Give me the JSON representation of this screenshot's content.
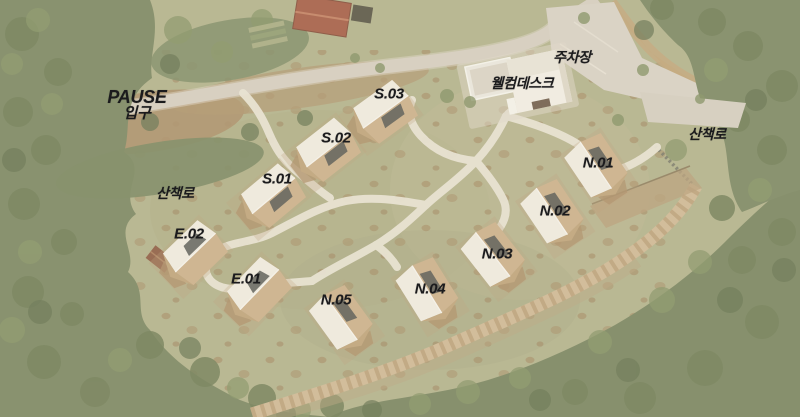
{
  "site_map": {
    "entrance": {
      "name": "PAUSE",
      "label": "입구"
    },
    "facilities": {
      "parking": "주차장",
      "welcome_desk": "웰컴데스크"
    },
    "trails": {
      "west": "산책로",
      "east": "산책로"
    },
    "units": {
      "s01": "S.01",
      "s02": "S.02",
      "s03": "S.03",
      "n01": "N.01",
      "n02": "N.02",
      "n03": "N.03",
      "n04": "N.04",
      "n05": "N.05",
      "e01": "E.01",
      "e02": "E.02"
    }
  },
  "colors": {
    "label_text": "#1b1b1d",
    "meadow": "#b0af87",
    "forest": "#6c7950",
    "path_white": "#e7e1d0",
    "road_pavement": "#d4ccbc",
    "stone_wall": "#cdb690",
    "cabin_roof": "#efeadd",
    "cabin_wall": "#c9ad85",
    "window_panel": "#4b4e49",
    "welcome_building": "#f1ede2",
    "red_roof_house": "#a2583f"
  }
}
